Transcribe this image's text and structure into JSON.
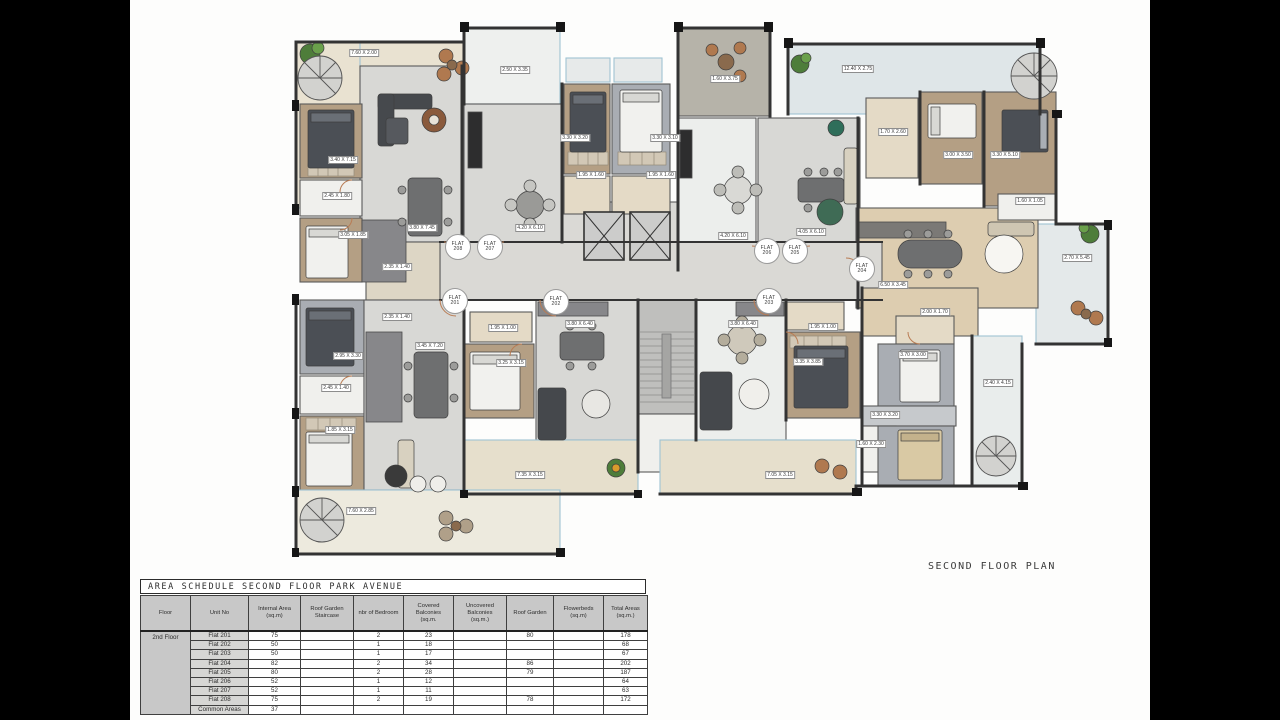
{
  "colors": {
    "background": "#000000",
    "paper": "#fdfdfc",
    "wall": "#3c3c3c",
    "wood_floor": "#b49f84",
    "gray_floor": "#d8d8d5",
    "marble_floor": "#eceeec",
    "terrace_cream": "#e9e2d1",
    "terrace_pale": "#dfe6e8",
    "granite": "#b6b3a9",
    "table_header_bg": "#c8c8c8"
  },
  "plan": {
    "title": "SECOND FLOOR PLAN",
    "flat_labels": [
      {
        "label": "FLAT",
        "number": "208",
        "x": 458,
        "y": 247
      },
      {
        "label": "FLAT",
        "number": "207",
        "x": 490,
        "y": 247
      },
      {
        "label": "FLAT",
        "number": "206",
        "x": 767,
        "y": 251
      },
      {
        "label": "FLAT",
        "number": "205",
        "x": 795,
        "y": 251
      },
      {
        "label": "FLAT",
        "number": "204",
        "x": 862,
        "y": 269
      },
      {
        "label": "FLAT",
        "number": "201",
        "x": 455,
        "y": 301
      },
      {
        "label": "FLAT",
        "number": "202",
        "x": 556,
        "y": 302
      },
      {
        "label": "FLAT",
        "number": "203",
        "x": 769,
        "y": 301
      }
    ],
    "dimension_labels": [
      {
        "text": "7.60 X 2.00",
        "x": 364,
        "y": 53
      },
      {
        "text": "2.50 X 3.35",
        "x": 515,
        "y": 70
      },
      {
        "text": "1.60 X 3.75",
        "x": 725,
        "y": 79
      },
      {
        "text": "12.40 X 2.75",
        "x": 858,
        "y": 69
      },
      {
        "text": "3.40 X 7.15",
        "x": 343,
        "y": 160
      },
      {
        "text": "2.45 X 1.80",
        "x": 337,
        "y": 196
      },
      {
        "text": "3.80 X 7.45",
        "x": 422,
        "y": 228
      },
      {
        "text": "4.20 X 6.10",
        "x": 530,
        "y": 228
      },
      {
        "text": "3.30 X 3.20",
        "x": 575,
        "y": 138
      },
      {
        "text": "3.30 X 3.10",
        "x": 665,
        "y": 138
      },
      {
        "text": "1.95 X 1.60",
        "x": 591,
        "y": 175
      },
      {
        "text": "1.95 X 1.60",
        "x": 661,
        "y": 175
      },
      {
        "text": "4.20 X 6.10",
        "x": 733,
        "y": 236
      },
      {
        "text": "4.05 X 6.10",
        "x": 811,
        "y": 232
      },
      {
        "text": "1.70 X 2.60",
        "x": 893,
        "y": 132
      },
      {
        "text": "3.00 X 3.50",
        "x": 958,
        "y": 155
      },
      {
        "text": "3.30 X 5.10",
        "x": 1005,
        "y": 155
      },
      {
        "text": "1.60 X 1.05",
        "x": 1030,
        "y": 201
      },
      {
        "text": "6.50 X 3.45",
        "x": 893,
        "y": 285
      },
      {
        "text": "2.70 X 5.45",
        "x": 1077,
        "y": 258
      },
      {
        "text": "3.05 X 1.85",
        "x": 353,
        "y": 235
      },
      {
        "text": "2.35 X 1.40",
        "x": 397,
        "y": 267
      },
      {
        "text": "2.35 X 1.40",
        "x": 397,
        "y": 317
      },
      {
        "text": "2.95 X 3.30",
        "x": 348,
        "y": 356
      },
      {
        "text": "3.45 X 7.20",
        "x": 430,
        "y": 346
      },
      {
        "text": "2.45 X 1.40",
        "x": 336,
        "y": 388
      },
      {
        "text": "1.85 X 3.15",
        "x": 340,
        "y": 430
      },
      {
        "text": "7.60 X 2.85",
        "x": 361,
        "y": 511
      },
      {
        "text": "1.95 X 1.00",
        "x": 503,
        "y": 328
      },
      {
        "text": "3.25 X 3.15",
        "x": 511,
        "y": 363
      },
      {
        "text": "7.35 X 3.15",
        "x": 530,
        "y": 475
      },
      {
        "text": "3.80 X 6.40",
        "x": 580,
        "y": 324
      },
      {
        "text": "3.80 X 6.40",
        "x": 743,
        "y": 324
      },
      {
        "text": "1.95 X 1.00",
        "x": 823,
        "y": 327
      },
      {
        "text": "3.35 X 3.85",
        "x": 808,
        "y": 362
      },
      {
        "text": "7.05 X 3.15",
        "x": 780,
        "y": 475
      },
      {
        "text": "2.00 X 1.70",
        "x": 935,
        "y": 312
      },
      {
        "text": "3.70 X 3.00",
        "x": 913,
        "y": 355
      },
      {
        "text": "2.40 X 4.15",
        "x": 998,
        "y": 383
      },
      {
        "text": "3.30 X 3.20",
        "x": 885,
        "y": 415
      },
      {
        "text": "1.60 X 2.30",
        "x": 871,
        "y": 444
      }
    ]
  },
  "schedule": {
    "title": "AREA SCHEDULE SECOND FLOOR PARK AVENUE",
    "columns": [
      "Floor",
      "Unit No",
      "Internal Area\n(sq.m)",
      "Roof Garden\nStaircase",
      "nbr of Bedroom",
      "Covered\nBalconies\n(sq.m.",
      "Uncovered\nBalconies\n(sq.m.)",
      "Roof Garden",
      "Flowerbeds\n(sq.m)",
      "Total Areas\n(sq.m.)"
    ],
    "floor_label": "2nd Floor",
    "rows": [
      {
        "unit": "Flat 201",
        "values": [
          "75",
          "",
          "2",
          "23",
          "",
          "80",
          "",
          "178"
        ]
      },
      {
        "unit": "Flat 202",
        "values": [
          "50",
          "",
          "1",
          "18",
          "",
          "",
          "",
          "68"
        ]
      },
      {
        "unit": "Flat 203",
        "values": [
          "50",
          "",
          "1",
          "17",
          "",
          "",
          "",
          "67"
        ]
      },
      {
        "unit": "Flat 204",
        "values": [
          "82",
          "",
          "2",
          "34",
          "",
          "86",
          "",
          "202"
        ]
      },
      {
        "unit": "Flat 205",
        "values": [
          "80",
          "",
          "2",
          "28",
          "",
          "79",
          "",
          "187"
        ]
      },
      {
        "unit": "Flat 206",
        "values": [
          "52",
          "",
          "1",
          "12",
          "",
          "",
          "",
          "64"
        ]
      },
      {
        "unit": "Flat 207",
        "values": [
          "52",
          "",
          "1",
          "11",
          "",
          "",
          "",
          "63"
        ]
      },
      {
        "unit": "Flat 208",
        "values": [
          "75",
          "",
          "2",
          "19",
          "",
          "78",
          "",
          "172"
        ]
      },
      {
        "unit": "Common Areas",
        "values": [
          "37",
          "",
          "",
          "",
          "",
          "",
          "",
          ""
        ]
      }
    ]
  }
}
